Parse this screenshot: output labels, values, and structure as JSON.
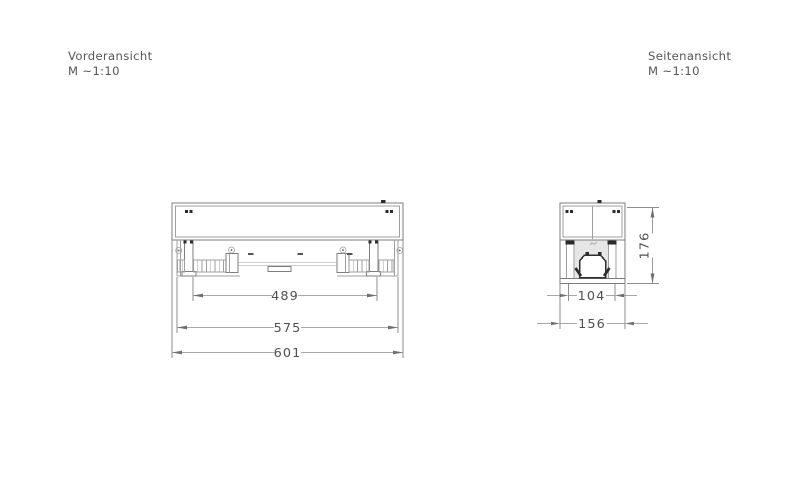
{
  "page": {
    "background": "#ffffff"
  },
  "drawing_colors": {
    "line": "#7d7d7d",
    "dark_marks": "#2b2b2b",
    "text": "#4f4f4f"
  },
  "front_view": {
    "title": "Vorderansicht",
    "scale": "M ~1:10",
    "dim_inner": "489",
    "dim_middle": "575",
    "dim_outer": "601"
  },
  "side_view": {
    "title": "Seitenansicht",
    "scale": "M ~1:10",
    "dim_width_inner": "104",
    "dim_width_outer": "156",
    "dim_height": "176"
  }
}
